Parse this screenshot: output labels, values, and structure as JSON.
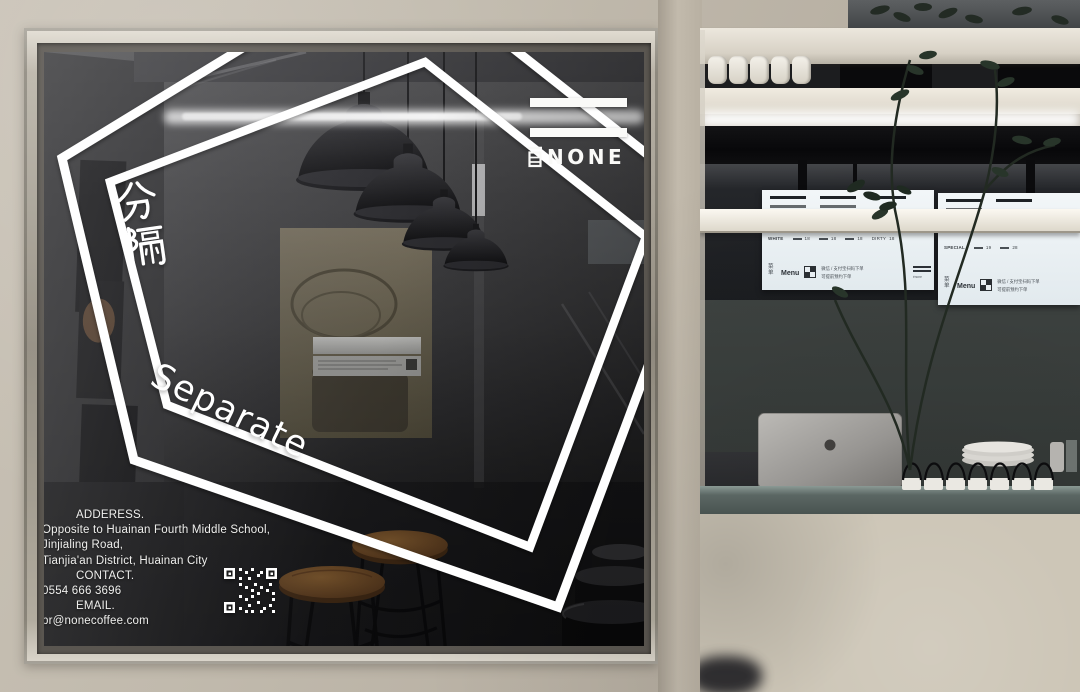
{
  "storefront": {
    "brand": {
      "logo_word": "NONE",
      "logo_prefix": "自",
      "logo_mark": "two-horizontal-bars"
    },
    "window_art": {
      "cn_vertical": "分隔",
      "en_word": "Separate"
    },
    "contact": {
      "address_heading": "ADDERESS.",
      "address_line1": "Opposite to Huainan Fourth Middle School,",
      "address_line2": "Jinjialing Road,",
      "address_line3": "Tianjia'an District, Huainan City",
      "contact_heading": "CONTACT.",
      "phone": "0554 666 3696",
      "email_heading": "EMAIL.",
      "email": "pr@nonecoffee.com"
    }
  },
  "menu_boards": {
    "board1": {
      "category_label": "WHITE",
      "highlight_item": "DIRTY",
      "item_prices": [
        "18",
        "18",
        "18",
        "18"
      ],
      "menu_label_cn": "菜单",
      "menu_label_en": "Menu",
      "order_note_line1": "微信 / 支付宝扫码下单",
      "order_note_line2": "可提前预约下单",
      "brand_mark": "énone"
    },
    "board2": {
      "category_label": "SPECIAL",
      "item_prices": [
        "19",
        "28"
      ],
      "menu_label_cn": "菜单",
      "menu_label_en": "Menu",
      "order_note_line1": "微信 / 支付宝扫码下单",
      "order_note_line2": "可提前预约下单"
    }
  },
  "colors": {
    "wall": "#bdb5a8",
    "vinyl_white": "#ffffff",
    "glass_dark": "#232528",
    "board_white": "#edf2f6",
    "signage_black": "#0b0b0d",
    "wood": "#8a5a2e",
    "counter_top": "#5b6764",
    "counter_front": "#cdc6b7"
  }
}
